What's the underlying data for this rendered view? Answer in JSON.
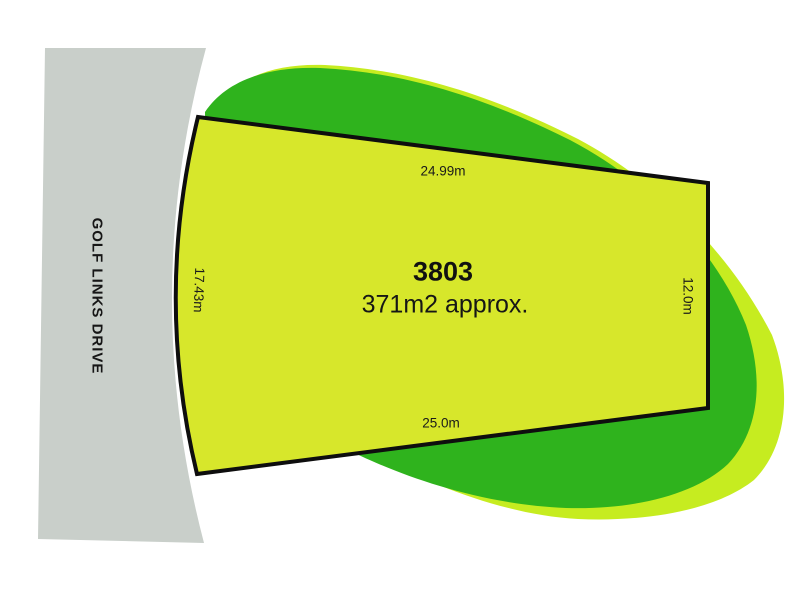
{
  "plan": {
    "street": {
      "label": "GOLF LINKS DRIVE"
    },
    "lot": {
      "number": "3803",
      "area": "371m2 approx.",
      "dim_top": "24.99m",
      "dim_bottom": "25.0m",
      "dim_left": "17.43m",
      "dim_right": "12.0m"
    },
    "colors": {
      "background": "#ffffff",
      "road_gray": "#c9cfca",
      "blob_halo": "#c6ec20",
      "blob_green": "#2fb31d",
      "lot_fill": "#d7e72b",
      "lot_border": "#0e0e0e",
      "text": "#1a1a1a"
    }
  }
}
